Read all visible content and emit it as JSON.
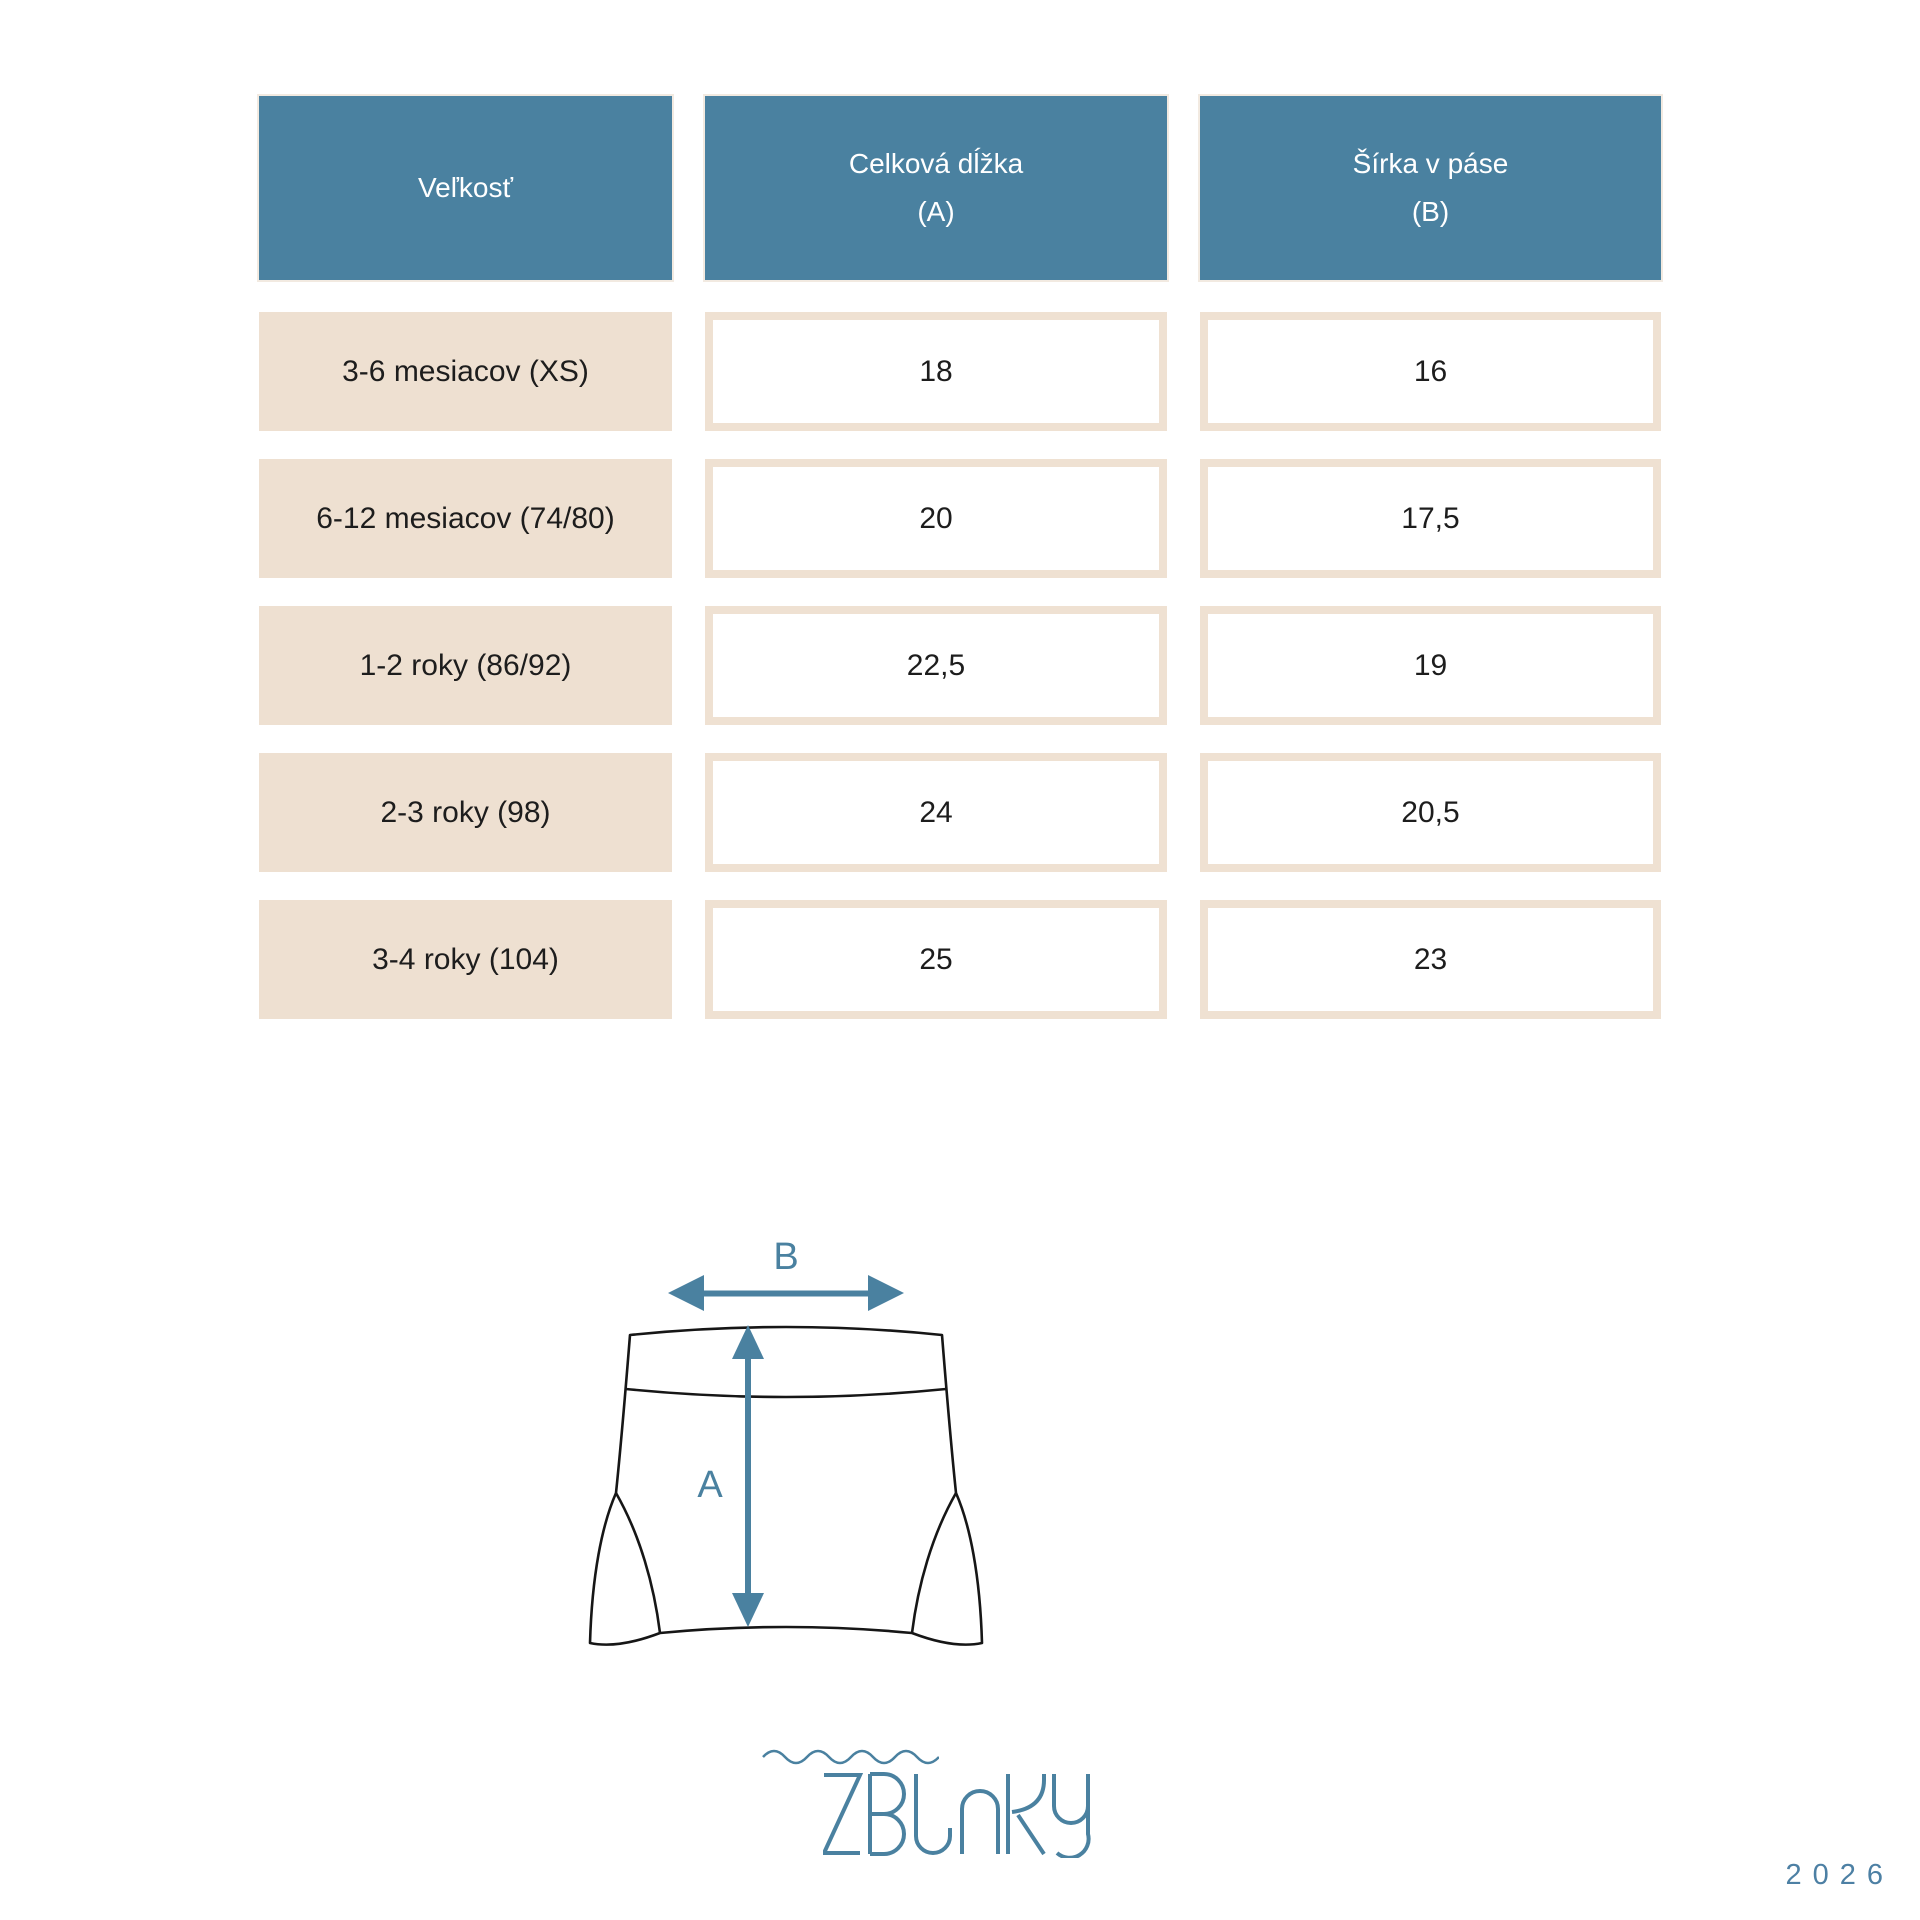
{
  "table": {
    "headers": [
      {
        "title": "Veľkosť",
        "unit": ""
      },
      {
        "title": "Celková dĺžka",
        "unit": "(A)"
      },
      {
        "title": "Šírka v páse",
        "unit": "(B)"
      }
    ],
    "rows": [
      {
        "size": "3-6 mesiacov (XS)",
        "length_a": "18",
        "width_b": "16"
      },
      {
        "size": "6-12 mesiacov (74/80)",
        "length_a": "20",
        "width_b": "17,5"
      },
      {
        "size": "1-2 roky (86/92)",
        "length_a": "22,5",
        "width_b": "19"
      },
      {
        "size": "2-3 roky (98)",
        "length_a": "24",
        "width_b": "20,5"
      },
      {
        "size": "3-4 roky (104)",
        "length_a": "25",
        "width_b": "23"
      }
    ]
  },
  "diagram": {
    "a_label": "A",
    "b_label": "B"
  },
  "footer": {
    "brand": "ZBLNKY",
    "year": "2026"
  },
  "colors": {
    "header_teal": "#4a81a0",
    "row_beige": "#eee0d1",
    "cell_border_beige": "#efe1d2",
    "accent_teal": "#4a81a0",
    "garment_outline": "#161616",
    "text_dark": "#1d1d1d"
  }
}
